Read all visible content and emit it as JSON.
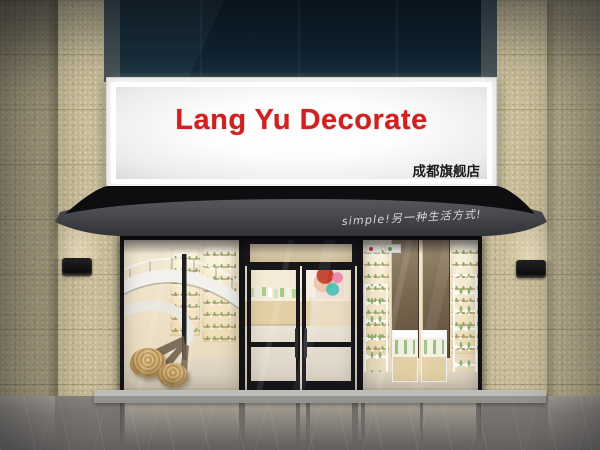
{
  "scene": {
    "description": "3D render of a cosmetics shop storefront with illuminated signboard, dark metal awning, glass facade, spiral staircase and product display shelves",
    "signboard": {
      "title": "Lang Yu Decorate",
      "title_color": "#d02020",
      "branch_label": "成都旗舰店",
      "branch_label_color": "#1b1b1b",
      "panel_color": "#fdfdfd"
    },
    "awning": {
      "slogan": "simple!另一种生活方式!",
      "slogan_color": "#d8d8d8",
      "canopy_color": "#0e0e10",
      "fascia_color": "#4b4c51"
    },
    "facade": {
      "tile_color": "#c8bd99",
      "upper_wall_color": "#102230",
      "frame_color": "#131315",
      "floor_color": "#8e8a85",
      "interior_warm_color": "#f0e4ca"
    },
    "interior": {
      "left_window": "spiral staircase, wooden deer sculpture, rattan poufs, backlit product shelves",
      "entrance": "double glass doors, beauty poster, reception counter with cosmetics",
      "right_window": "backlit wooden shelves, bronze mirror panels, white display cabinets with green skincare products"
    }
  }
}
